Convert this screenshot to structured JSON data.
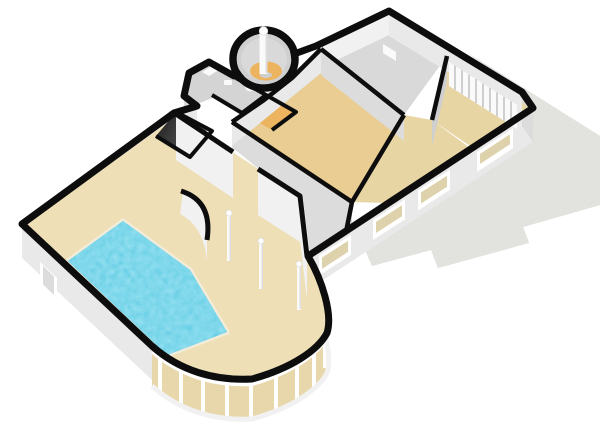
{
  "meta": {
    "kind": "3d-floorplan-render",
    "view": "isometric-overview",
    "canvas": {
      "width": 600,
      "height": 424
    }
  },
  "labels": {
    "title": "3D floor plan render",
    "description": "Isometric 3D render of a single-storey floor plan: indoor swimming pool hall with curved conservatory glazing, round tower room with column, dark stairwell, tan corridors, bedroom wing with wardrobe slats and windows, and a stepped grey stone patio."
  },
  "colors": {
    "background": "#ffffff",
    "wall_cap": "#0d0d0d",
    "wall_face_white": "#f1f1f1",
    "wall_face_light": "#e9e9e9",
    "wall_face_mid": "#dcdcdc",
    "wall_face_dark": "#cfcfcf",
    "floor_room_gray": "#d9d9d9",
    "floor_small_gray": "#d4d4d4",
    "floor_hall_tan": "#eedfb6",
    "floor_corridor_tan": "#e9cd92",
    "floor_bedroom_tan": "#e8d5a4",
    "floor_tower_orange": "#ecb45e",
    "stair_dark": "#2c2c2c",
    "stair_light": "#9a9a9a",
    "pool_water": "#2fb6df",
    "pool_rim": "#f2ecd9",
    "patio_gray": "#c9cac2",
    "glass_cream": "#e8d7aa",
    "window_pane": "#ddd2ac",
    "mullion_white": "#ffffff",
    "fixture_white": "#fafafa"
  },
  "scene": {
    "rooms": [
      {
        "name": "pool-hall",
        "floor": "tan",
        "features": [
          "swimming-pool",
          "deck-columns",
          "curved-conservatory"
        ]
      },
      {
        "name": "tower-room",
        "floor": "gray-orange",
        "features": [
          "round-wall",
          "center-column"
        ]
      },
      {
        "name": "entrance-porch",
        "floor": "gray",
        "features": [
          "chamfered-corner",
          "step"
        ]
      },
      {
        "name": "stairwell",
        "floor": "dark",
        "features": []
      },
      {
        "name": "great-room",
        "floor": "gray",
        "features": [
          "wall-fixture"
        ]
      },
      {
        "name": "corridor",
        "floor": "tan",
        "features": []
      },
      {
        "name": "bedroom-middle",
        "floor": "tan",
        "features": [
          "window"
        ]
      },
      {
        "name": "bedroom-east",
        "floor": "tan",
        "features": [
          "wardrobe-slats",
          "window"
        ]
      },
      {
        "name": "room-small-a",
        "floor": "gray",
        "features": [
          "fixtures"
        ]
      }
    ],
    "exterior": [
      {
        "name": "patio",
        "surface": "stone-speckle",
        "shape": "stepped"
      },
      {
        "name": "windows-wall",
        "window_count": 4
      },
      {
        "name": "west-wall-door",
        "count": 1
      }
    ]
  }
}
